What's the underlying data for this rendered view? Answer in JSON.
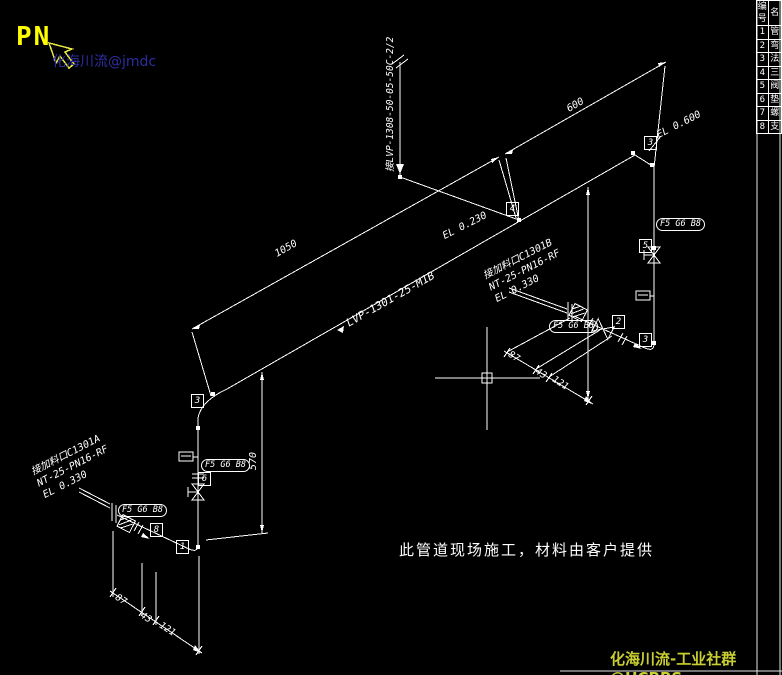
{
  "app": {
    "background": "#000000",
    "line_color": "#ffffff"
  },
  "watermarks": {
    "pn": "PN",
    "top": "化海川流@jmdc",
    "bottom": "化海川流-工业社群@HCBBS"
  },
  "colors": {
    "pn": "#ffff00",
    "watermark_top": "#2d2da0",
    "watermark_bottom": "#c9cf30",
    "cursor_arrow": "#e8e840"
  },
  "note": "此管道现场施工，材料由客户提供",
  "labels": {
    "main_pipe": "LVP-1301-25-M1B",
    "branch_pipe": "接LVP-1308-50-05-50C-2/2",
    "el_top": "EL 0.600",
    "el_mid": "EL 0.230",
    "fitting_tag": "F5 G6 B8"
  },
  "nozzles": {
    "left": {
      "line1": "接加料口C1301A",
      "line2": "NT-25-PN16-RF",
      "line3": "EL 0.330"
    },
    "right": {
      "line1": "接加料口C1301B",
      "line2": "NT-25-PN16-RF",
      "line3": "EL 0.330"
    }
  },
  "dims": {
    "d600": "600",
    "d1050": "1050",
    "d570": "570",
    "chain": [
      "87",
      "43",
      "121"
    ]
  },
  "bubbles": [
    "4",
    "3",
    "5",
    "2",
    "3",
    "3",
    "6",
    "1",
    "8"
  ],
  "bom": {
    "header": {
      "no": "编号",
      "name": "名"
    },
    "rows": [
      {
        "no": "1",
        "name": "管"
      },
      {
        "no": "2",
        "name": "弯"
      },
      {
        "no": "3",
        "name": "法"
      },
      {
        "no": "4",
        "name": "三"
      },
      {
        "no": "5",
        "name": "阀"
      },
      {
        "no": "6",
        "name": "垫"
      },
      {
        "no": "7",
        "name": "螺"
      },
      {
        "no": "8",
        "name": "支"
      }
    ]
  }
}
